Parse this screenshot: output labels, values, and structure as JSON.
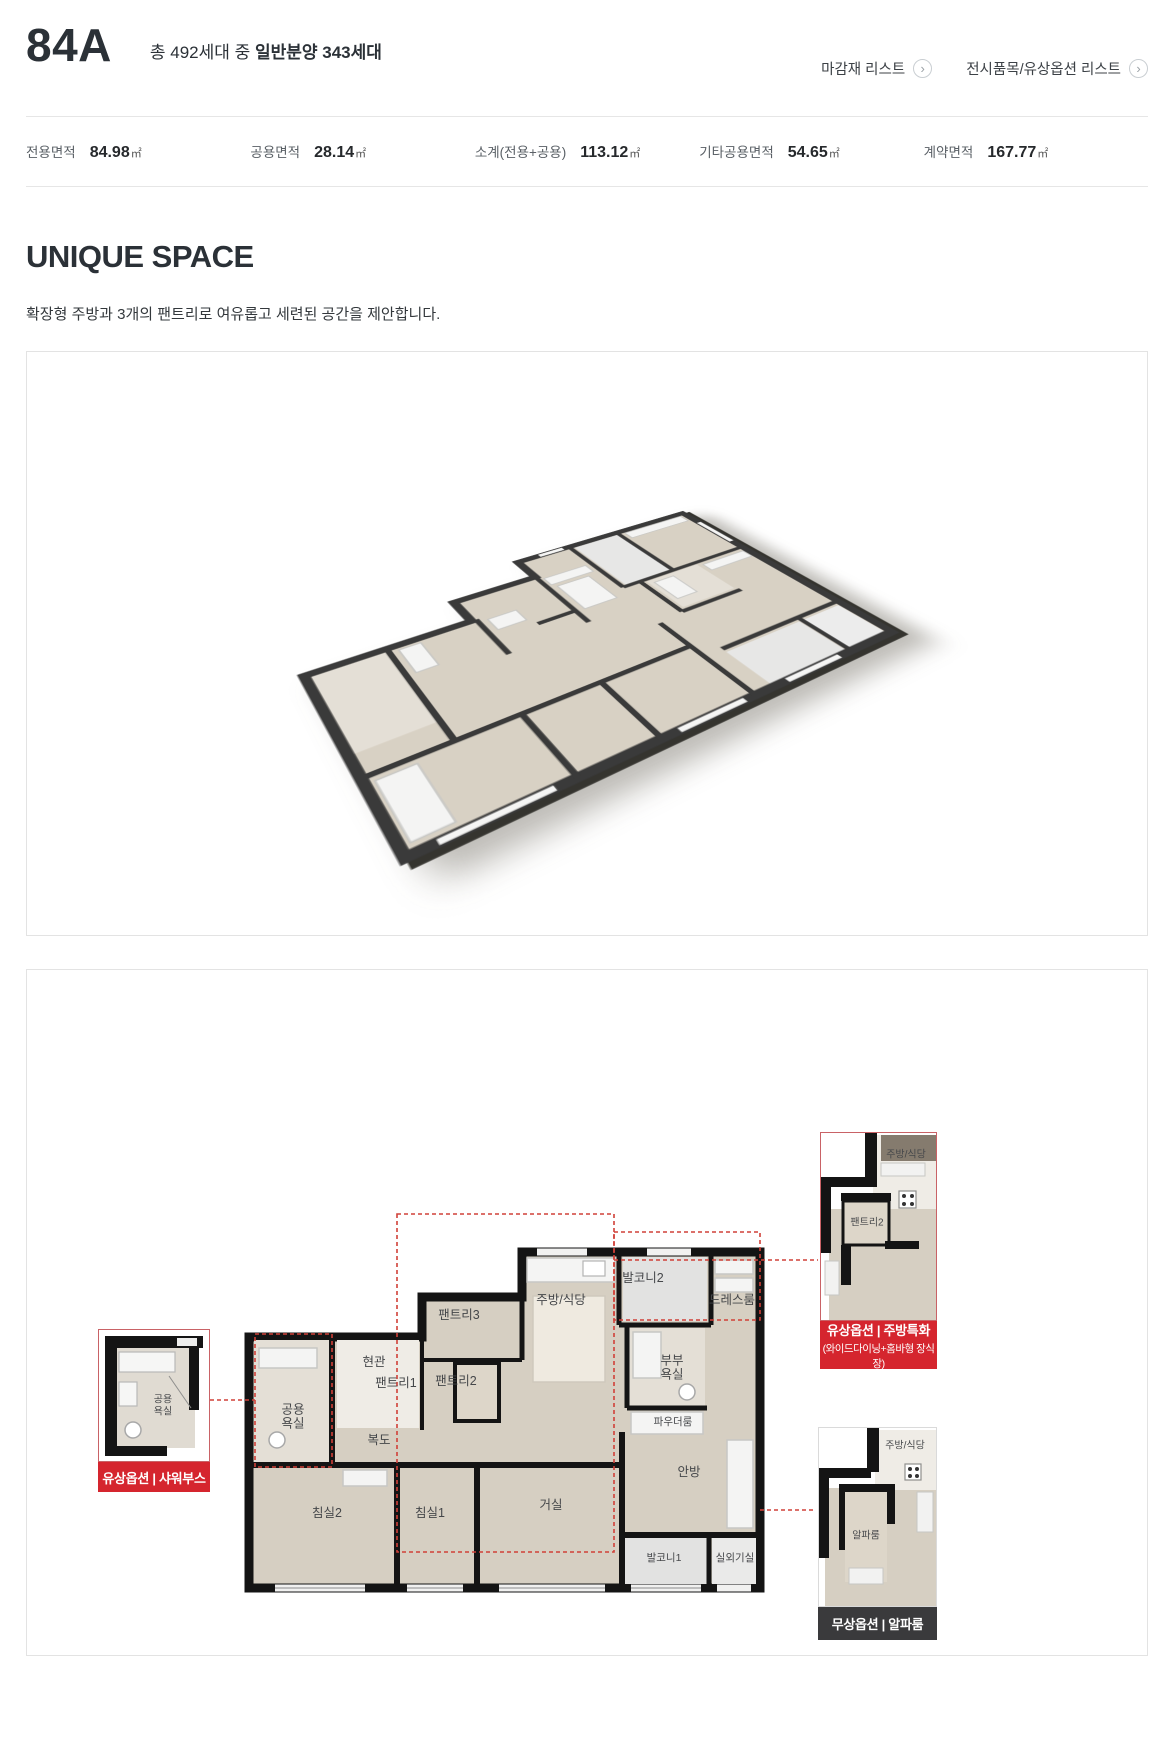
{
  "header": {
    "unit_type": "84A",
    "summary_prefix": "총 492세대 중 ",
    "summary_bold": "일반분양 343세대",
    "link_finish_list": "마감재 리스트",
    "link_option_list": "전시품목/유상옵션 리스트"
  },
  "specs": {
    "items": [
      {
        "label": "전용면적",
        "value": "84.98",
        "unit": "㎡"
      },
      {
        "label": "공용면적",
        "value": "28.14",
        "unit": "㎡"
      },
      {
        "label": "소계(전용+공용)",
        "value": "113.12",
        "unit": "㎡"
      },
      {
        "label": "기타공용면적",
        "value": "54.65",
        "unit": "㎡"
      },
      {
        "label": "계약면적",
        "value": "167.77",
        "unit": "㎡"
      }
    ]
  },
  "unique_space": {
    "title": "UNIQUE SPACE",
    "description": "확장형 주방과 3개의 팬트리로 여유롭고 세련된 공간을 제안합니다."
  },
  "plan2d": {
    "rooms": {
      "pantry3": "팬트리3",
      "kitchen": "주방/식당",
      "balcony2": "발코니2",
      "dressroom": "드레스룸",
      "entrance": "현관",
      "pantry1": "팬트리1",
      "pantry2": "팬트리2",
      "master_bath": "부부욕실",
      "powder_room": "파우더룸",
      "common_bath": "공용욕실",
      "hallway": "복도",
      "bedroom2": "침실2",
      "bedroom1": "침실1",
      "living": "거실",
      "master_room": "안방",
      "balcony1": "발코니1",
      "ac_room": "실외기실"
    },
    "callout_shower": {
      "room": "공용욕실",
      "badge": "유상옵션 | 샤워부스"
    },
    "callout_kitchen": {
      "room_pantry": "팬트리2",
      "room_kitchen": "주방/식당",
      "badge": "유상옵션 | 주방특화",
      "badge_sub": "(와이드다이닝+홈바형 장식장)"
    },
    "callout_alpha": {
      "room_alpha": "알파룸",
      "room_kitchen": "주방/식당",
      "badge": "무상옵션 | 알파룸"
    }
  },
  "colors": {
    "accent_red": "#d5252e",
    "banner_dark": "#3a3a3c",
    "dashed_red": "#d04038",
    "floor_beige": "#d6cfc2",
    "wall_black": "#141414"
  }
}
